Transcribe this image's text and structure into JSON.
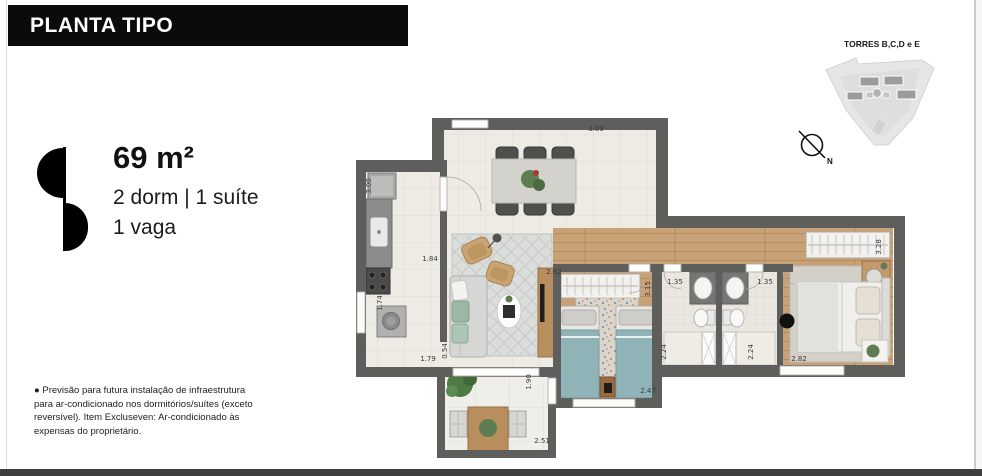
{
  "header": {
    "title": "PLANTA TIPO"
  },
  "unit": {
    "area": "69 m²",
    "rooms": "2 dorm | 1 suíte",
    "parking": "1 vaga"
  },
  "towers": {
    "label": "TORRES B,C,D e E"
  },
  "compass": {
    "label": "N"
  },
  "disclaimer": {
    "lines": [
      "● Previsão para futura instalação de infraestrutura",
      "para ar-condicionado nos dormitórios/suítes (exceto",
      "reversível). Item Excluseven: Ar-condicionado às",
      "expensas do proprietário."
    ]
  },
  "colors": {
    "header_bg": "#0b0b0b",
    "wall": "#5e5e5c",
    "wood_floor": "#c9a176",
    "tile_floor": "#edebe4",
    "ac_marker": "#111111"
  },
  "floorplan": {
    "dimensions": [
      {
        "value": "3.09",
        "x": 596,
        "y": 131,
        "rot": 0
      },
      {
        "value": "3.00",
        "x": 371,
        "y": 186,
        "rot": -90
      },
      {
        "value": "1.84",
        "x": 430,
        "y": 261,
        "rot": 0
      },
      {
        "value": "1.74",
        "x": 382,
        "y": 303,
        "rot": -90
      },
      {
        "value": "0.54",
        "x": 447,
        "y": 351,
        "rot": -90
      },
      {
        "value": "1.79",
        "x": 428,
        "y": 361,
        "rot": 0
      },
      {
        "value": "2.62",
        "x": 554,
        "y": 274,
        "rot": 0
      },
      {
        "value": "3.15",
        "x": 650,
        "y": 289,
        "rot": -90
      },
      {
        "value": "1.35",
        "x": 675,
        "y": 284,
        "rot": 0
      },
      {
        "value": "1.35",
        "x": 765,
        "y": 284,
        "rot": 0
      },
      {
        "value": "3.28",
        "x": 881,
        "y": 247,
        "rot": -90
      },
      {
        "value": "2.24",
        "x": 666,
        "y": 352,
        "rot": -90
      },
      {
        "value": "2.24",
        "x": 753,
        "y": 352,
        "rot": -90
      },
      {
        "value": "2.82",
        "x": 799,
        "y": 361,
        "rot": 0
      },
      {
        "value": "2.47",
        "x": 648,
        "y": 393,
        "rot": 0
      },
      {
        "value": "1.90",
        "x": 531,
        "y": 382,
        "rot": -90
      },
      {
        "value": "2.51",
        "x": 542,
        "y": 443,
        "rot": 0
      }
    ]
  }
}
